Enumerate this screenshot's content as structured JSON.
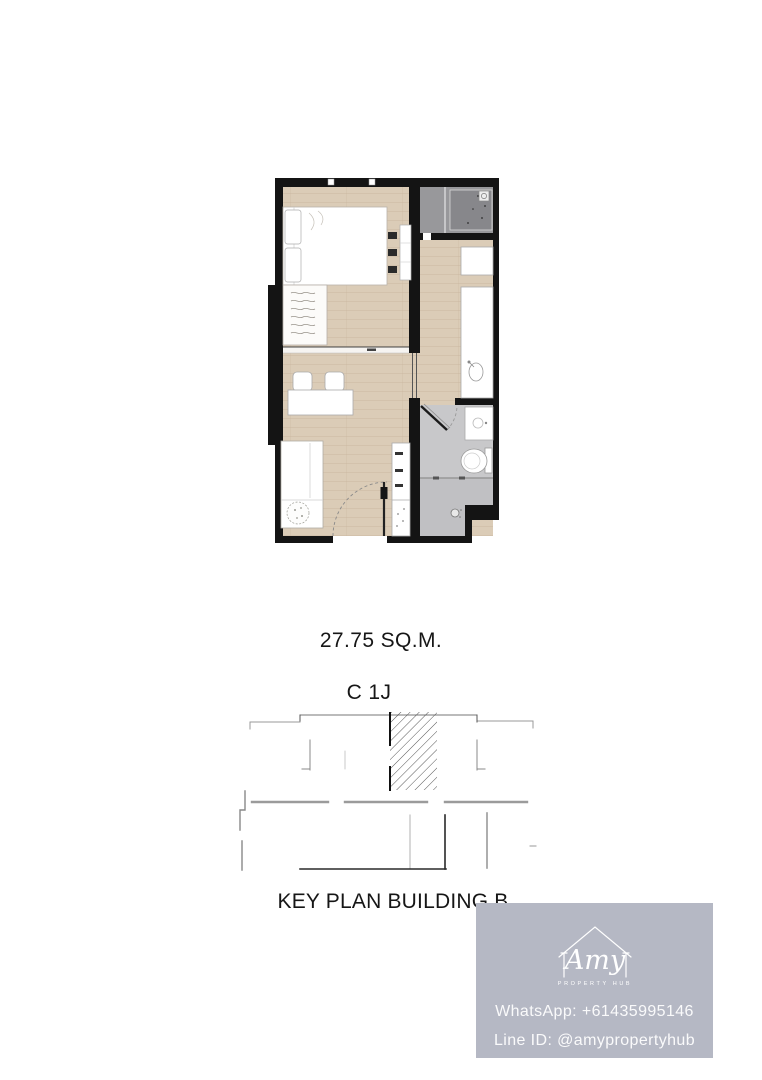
{
  "floor_plan": {
    "area_label": "27.75 SQ.M.",
    "unit_type": "C 1J",
    "colors": {
      "wall": "#141414",
      "wood_floor": "#dbccb7",
      "balcony_floor": "#98989b",
      "balcony_ac_pad": "#87878b",
      "bathroom_floor": "#c8c8ca",
      "shower_floor": "#c0c0c3",
      "furniture": "#ffffff"
    }
  },
  "key_plan": {
    "title": "KEY PLAN BUILDING B",
    "highlight": "hatched-unit-location"
  },
  "watermark": {
    "brand_script": "Amy",
    "brand_subtitle": "PROPERTY HUB",
    "whatsapp": "WhatsApp: +61435995146",
    "line_id": "Line ID: @amypropertyhub",
    "box_color": "#b5b8c4",
    "text_color": "#f5f5f8"
  }
}
